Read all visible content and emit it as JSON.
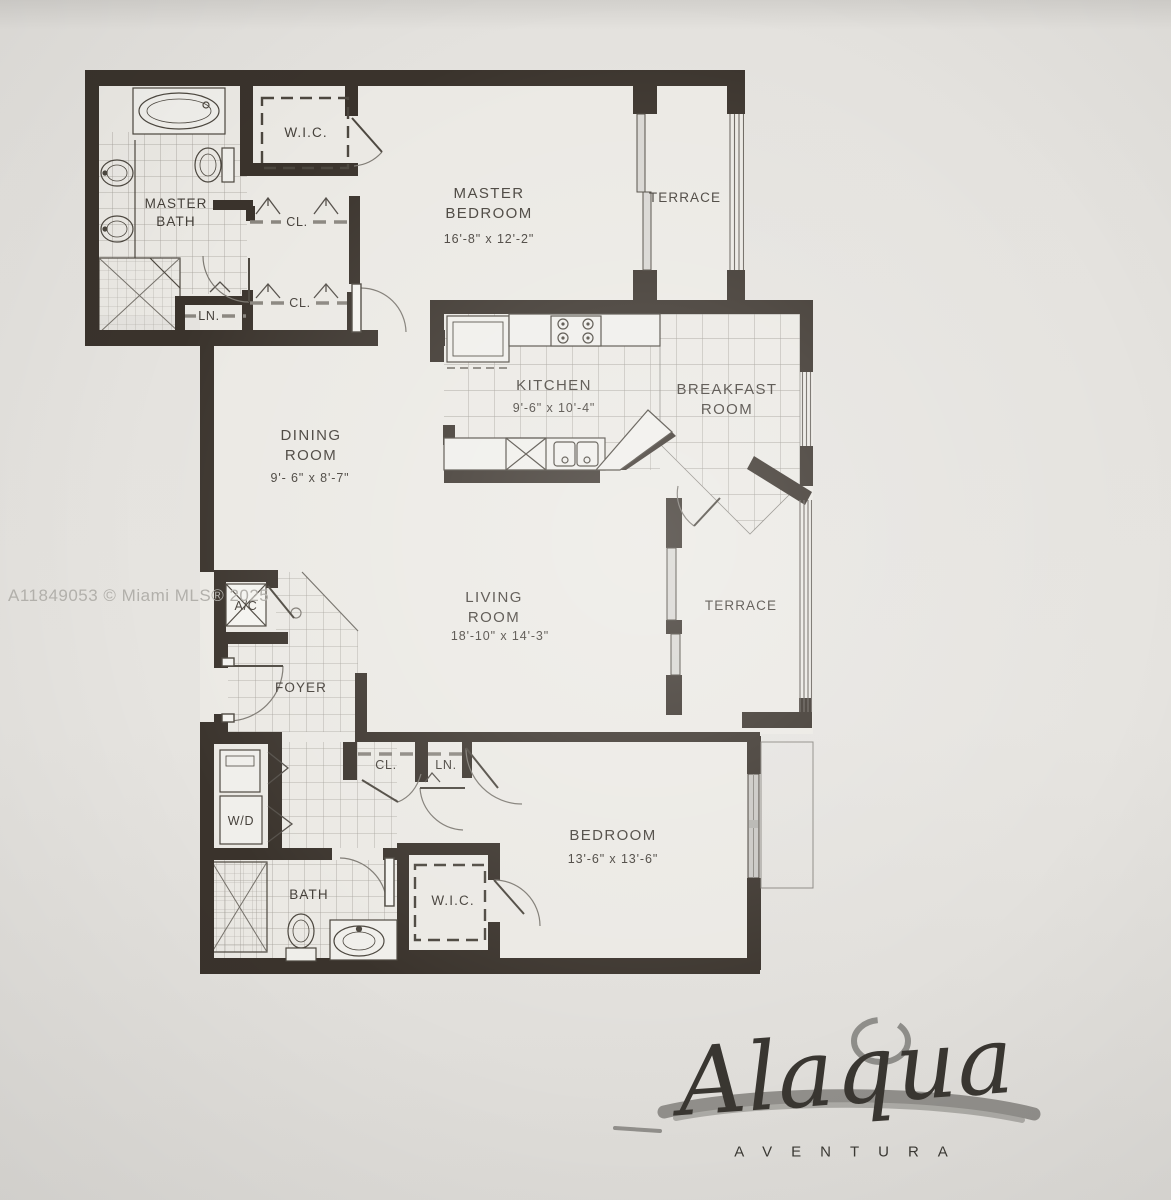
{
  "page": {
    "watermark": "A11849053 © Miami MLS® 2025"
  },
  "plan": {
    "rooms": {
      "master_bath": {
        "label": "MASTER\nBATH"
      },
      "wic_top": {
        "label": "W.I.C."
      },
      "closet_1": {
        "label": "CL."
      },
      "closet_2": {
        "label": "CL."
      },
      "linen_top": {
        "label": "LN."
      },
      "master_bedroom": {
        "label": "MASTER\nBEDROOM",
        "dims": "16'-8\" x 12'-2\""
      },
      "terrace_top": {
        "label": "TERRACE"
      },
      "kitchen": {
        "label": "KITCHEN",
        "dims": "9'-6\" x 10'-4\""
      },
      "breakfast_room": {
        "label": "BREAKFAST\nROOM"
      },
      "dining_room": {
        "label": "DINING\nROOM",
        "dims": "9'- 6\" x 8'-7\""
      },
      "ac": {
        "label": "A/C"
      },
      "foyer": {
        "label": "FOYER"
      },
      "living_room": {
        "label": "LIVING\nROOM",
        "dims": "18'-10\" x 14'-3\""
      },
      "terrace_right": {
        "label": "TERRACE"
      },
      "closet_bottom": {
        "label": "CL."
      },
      "linen_bottom": {
        "label": "LN."
      },
      "washer_dryer": {
        "label": "W/D"
      },
      "bath": {
        "label": "BATH"
      },
      "wic_bottom": {
        "label": "W.I.C."
      },
      "bedroom": {
        "label": "BEDROOM",
        "dims": "13'-6\" x 13'-6\""
      }
    },
    "colors": {
      "wall": "#3a332c",
      "fixture_line": "#4c473f",
      "tile_line": "#a29e97",
      "paper": "#e6e4e0",
      "floor": "#ebe9e4",
      "watermark": "#b2b0ab",
      "logo": "#393631",
      "brush": "#918f8b"
    }
  },
  "branding": {
    "name": "Alaqua",
    "location": "AVENTURA"
  }
}
